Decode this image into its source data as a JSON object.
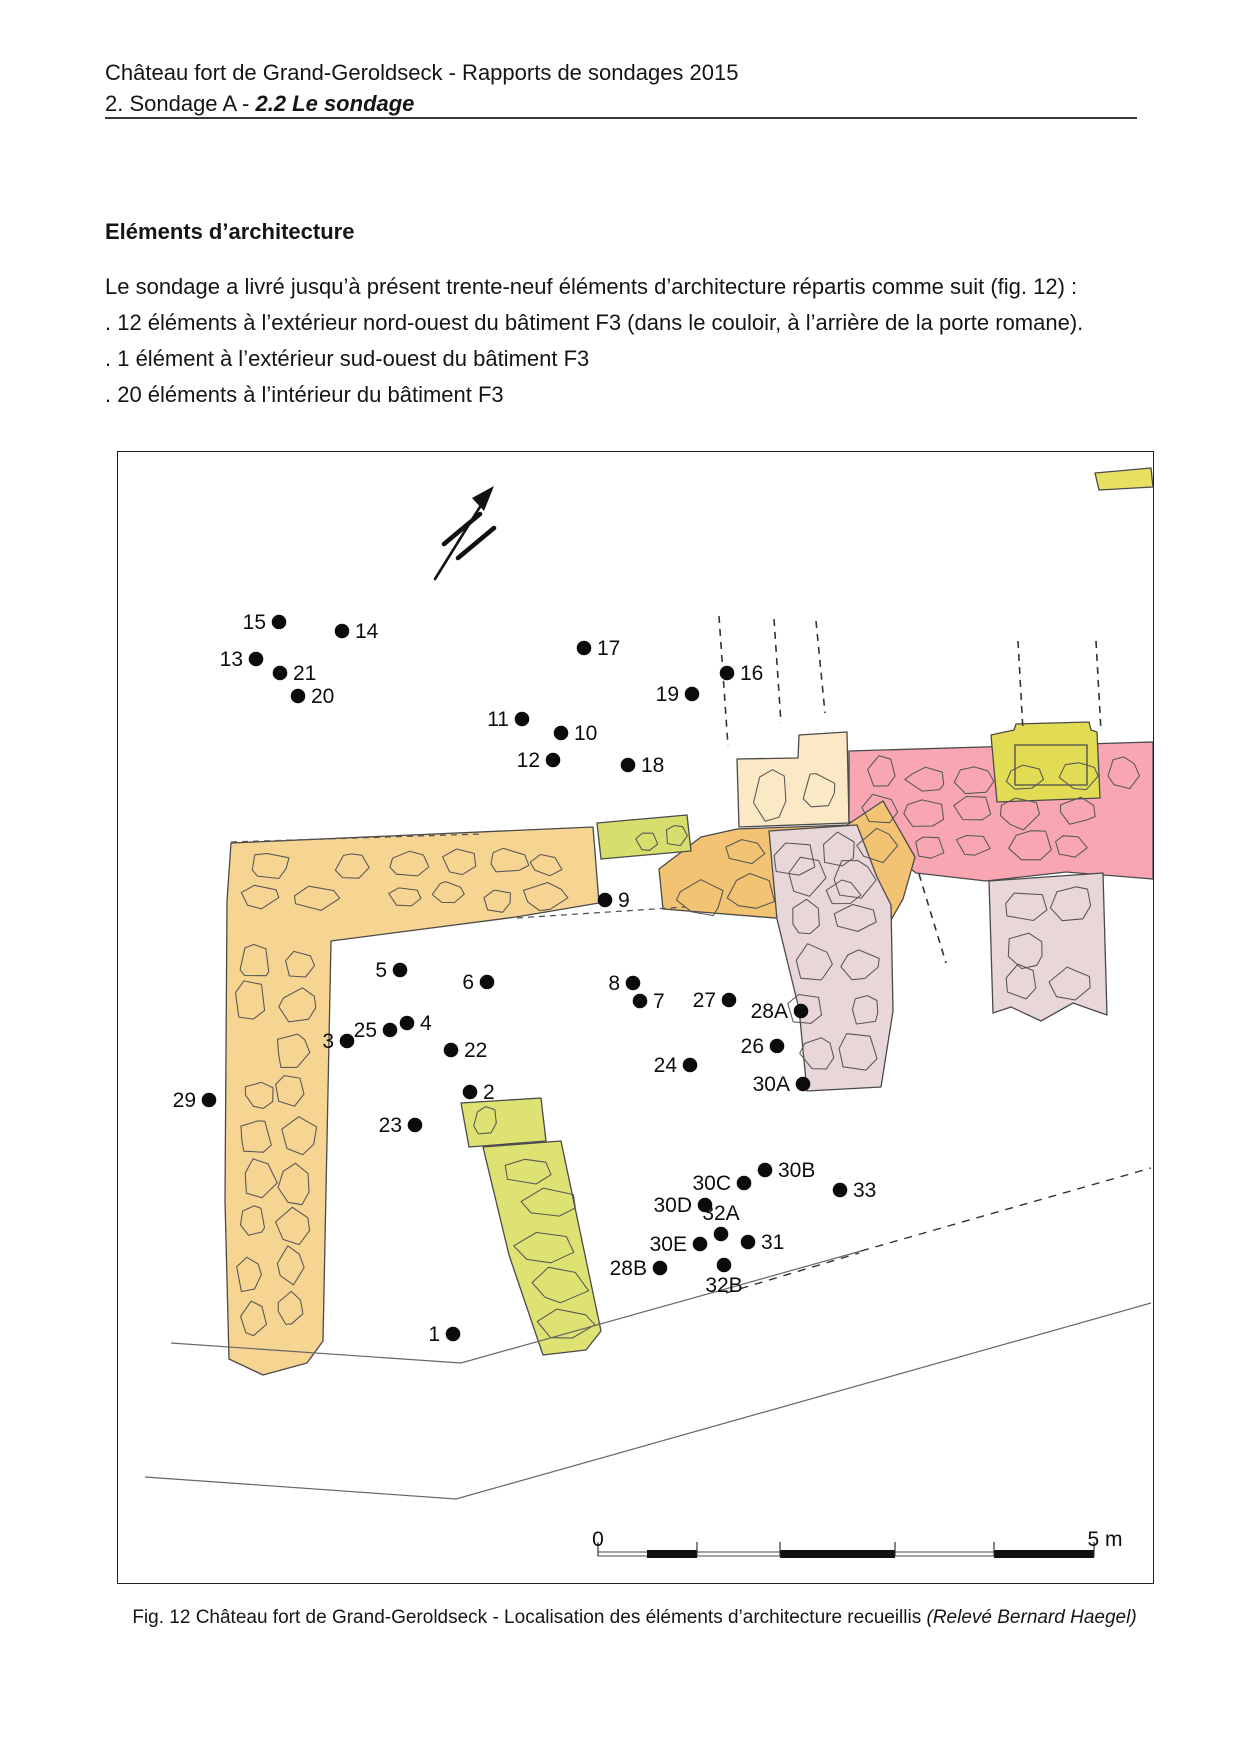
{
  "page": {
    "header": {
      "line1": "Château fort de Grand-Geroldseck - Rapports de sondages 2015",
      "line2_prefix": "2. Sondage A - ",
      "line2_emphasis": "2.2 Le sondage"
    },
    "body": {
      "section_title": "Eléments d’architecture",
      "intro": "Le sondage a livré jusqu’à présent trente-neuf éléments d’architecture répartis comme suit (fig. 12) :",
      "items": [
        ". 12 éléments à l’extérieur nord-ouest du bâtiment F3 (dans le couloir, à l’arrière de la porte romane).",
        ". 1 élément à l’extérieur sud-ouest du bâtiment F3",
        ". 20 éléments à l’intérieur du bâtiment F3"
      ]
    },
    "figure": {
      "scale_zero": "0",
      "scale_max": "5 m",
      "caption_text": "Fig. 12 Château fort de Grand-Geroldseck - Localisation des éléments d’architecture recueillis ",
      "caption_italic": "(Relevé Bernard Haegel)",
      "colors": {
        "tan": "#F6D492",
        "orange": "#F2C372",
        "cream": "#FAE9C4",
        "pink": "#F8A7B2",
        "mauve": "#E9D6D8",
        "yg_row": "#D8DE6E",
        "yg_block": "#E2DC55",
        "yg_wall": "#DDE272",
        "yg_strip": "#E8E060"
      },
      "points": [
        {
          "label": "1",
          "x": 452,
          "y": 1333,
          "side": "left"
        },
        {
          "label": "2",
          "x": 469,
          "y": 1091,
          "side": "right"
        },
        {
          "label": "3",
          "x": 346,
          "y": 1040,
          "side": "left"
        },
        {
          "label": "4",
          "x": 406,
          "y": 1022,
          "side": "right"
        },
        {
          "label": "5",
          "x": 399,
          "y": 969,
          "side": "left"
        },
        {
          "label": "6",
          "x": 486,
          "y": 981,
          "side": "left"
        },
        {
          "label": "7",
          "x": 639,
          "y": 1000,
          "side": "right"
        },
        {
          "label": "8",
          "x": 632,
          "y": 982,
          "side": "left"
        },
        {
          "label": "9",
          "x": 604,
          "y": 899,
          "side": "right"
        },
        {
          "label": "10",
          "x": 560,
          "y": 732,
          "side": "right"
        },
        {
          "label": "11",
          "x": 521,
          "y": 718,
          "side": "left"
        },
        {
          "label": "12",
          "x": 552,
          "y": 759,
          "side": "left"
        },
        {
          "label": "13",
          "x": 255,
          "y": 658,
          "side": "left"
        },
        {
          "label": "14",
          "x": 341,
          "y": 630,
          "side": "right"
        },
        {
          "label": "15",
          "x": 278,
          "y": 621,
          "side": "left"
        },
        {
          "label": "16",
          "x": 726,
          "y": 672,
          "side": "right"
        },
        {
          "label": "17",
          "x": 583,
          "y": 647,
          "side": "right"
        },
        {
          "label": "18",
          "x": 627,
          "y": 764,
          "side": "right"
        },
        {
          "label": "19",
          "x": 691,
          "y": 693,
          "side": "left"
        },
        {
          "label": "20",
          "x": 297,
          "y": 695,
          "side": "right"
        },
        {
          "label": "21",
          "x": 279,
          "y": 672,
          "side": "right"
        },
        {
          "label": "22",
          "x": 450,
          "y": 1049,
          "side": "right"
        },
        {
          "label": "23",
          "x": 414,
          "y": 1124,
          "side": "left"
        },
        {
          "label": "24",
          "x": 689,
          "y": 1064,
          "side": "left"
        },
        {
          "label": "25",
          "x": 389,
          "y": 1029,
          "side": "left"
        },
        {
          "label": "26",
          "x": 776,
          "y": 1045,
          "side": "left"
        },
        {
          "label": "27",
          "x": 728,
          "y": 999,
          "side": "left"
        },
        {
          "label": "28A",
          "x": 800,
          "y": 1010,
          "side": "left"
        },
        {
          "label": "28B",
          "x": 659,
          "y": 1267,
          "side": "left"
        },
        {
          "label": "29",
          "x": 208,
          "y": 1099,
          "side": "left"
        },
        {
          "label": "30A",
          "x": 802,
          "y": 1083,
          "side": "left"
        },
        {
          "label": "30B",
          "x": 764,
          "y": 1169,
          "side": "right"
        },
        {
          "label": "30C",
          "x": 743,
          "y": 1182,
          "side": "left"
        },
        {
          "label": "30D",
          "x": 704,
          "y": 1204,
          "side": "left"
        },
        {
          "label": "30E",
          "x": 699,
          "y": 1243,
          "side": "left"
        },
        {
          "label": "31",
          "x": 747,
          "y": 1241,
          "side": "right"
        },
        {
          "label": "32A",
          "x": 720,
          "y": 1233,
          "side": "above"
        },
        {
          "label": "32B",
          "x": 723,
          "y": 1264,
          "side": "below"
        },
        {
          "label": "33",
          "x": 839,
          "y": 1189,
          "side": "right"
        }
      ]
    }
  }
}
